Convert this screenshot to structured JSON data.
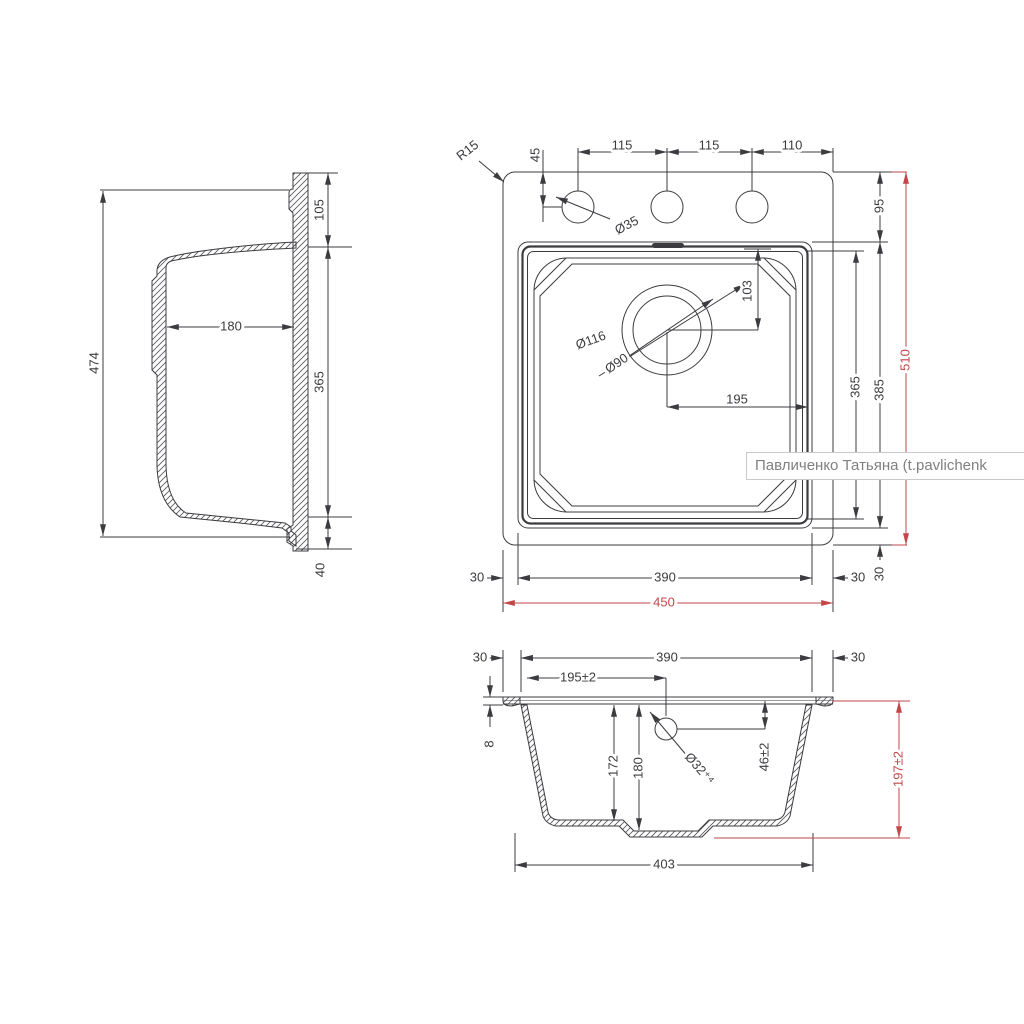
{
  "watermark": {
    "text": "Павличенко Татьяна (t.pavlichenk"
  },
  "colors": {
    "line": "#3c3c40",
    "dim_red": "#c2474b",
    "watermark_text": "#808080",
    "watermark_border": "#c9c9c9"
  },
  "side_view": {
    "overall_height": "474",
    "ledge_height": "105",
    "bowl_width": "180",
    "bowl_length": "365",
    "bottom_flange": "40"
  },
  "top_view": {
    "corner_radius": "R15",
    "hole_offset": "45",
    "hole_spacing_1": "115",
    "hole_spacing_2": "115",
    "hole_spacing_3": "110",
    "hole_diameter": "Ø35",
    "top_margin": "95",
    "drain_offset_top": "103",
    "drain_outer": "Ø116",
    "drain_inner": "Ø90",
    "drain_offset_right": "195",
    "bowl_inner_length": "365",
    "cutout_length": "385",
    "overall_length": "510",
    "margin_left": "30",
    "bowl_width": "390",
    "margin_right": "30",
    "overall_width": "450",
    "margin_bottom": "30"
  },
  "section_view": {
    "margin_left": "30",
    "bowl_width": "390",
    "margin_right": "30",
    "drain_offset": "195±2",
    "rim_thickness": "8",
    "depth_inner": "172",
    "depth_sump": "180",
    "drain_diameter": "Ø32⁺⁴",
    "drain_depth": "46±2",
    "overall_depth": "197±2",
    "base_width": "403"
  }
}
